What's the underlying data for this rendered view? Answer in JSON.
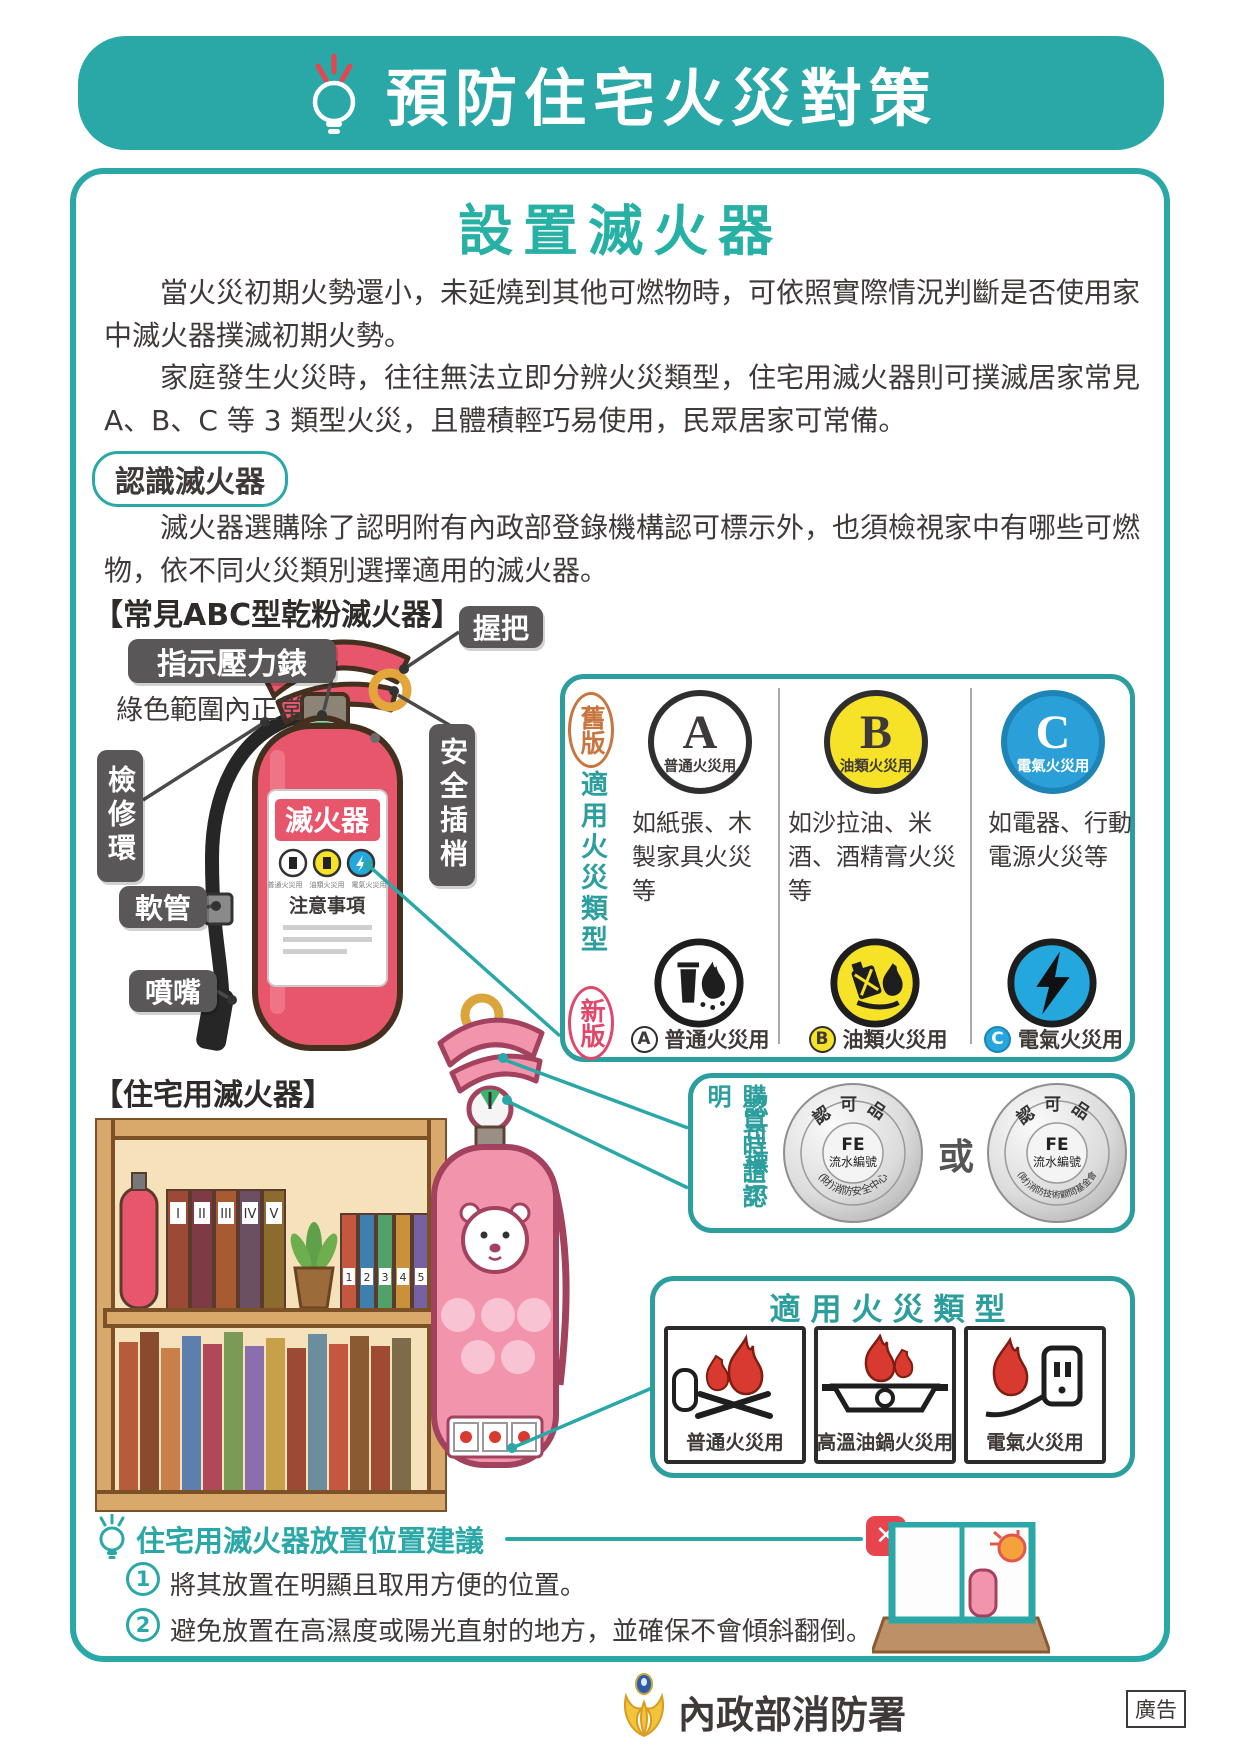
{
  "banner": {
    "title": "預防住宅火災對策"
  },
  "intro": {
    "heading": "設置滅火器",
    "para1": "當火災初期火勢還小，未延燒到其他可燃物時，可依照實際情況判斷是否使用家中滅火器撲滅初期火勢。",
    "para2": "家庭發生火災時，往往無法立即分辨火災類型，住宅用滅火器則可撲滅居家常見 A、B、C 等 3 類型火災，且體積輕巧易使用，民眾居家可常備。",
    "badge": "認識滅火器",
    "para3": "滅火器選購除了認明附有內政部登錄機構認可標示外，也須檢視家中有哪些可燃物，依不同火災類別選擇適用的滅火器。"
  },
  "abc_diagram": {
    "title": "【常見ABC型乾粉滅火器】",
    "label_handle": "握把",
    "label_gauge": "指示壓力錶",
    "gauge_note": "綠色範圍內正常",
    "label_ring": "檢修環",
    "label_pin": "安全插梢",
    "label_hose": "軟管",
    "label_nozzle": "噴嘴",
    "body_label": "滅火器",
    "mini_caption": "普通火災用　油類火災用　電氣火災用",
    "body_note": "注意事項"
  },
  "type_table": {
    "old_stamp": "舊版",
    "side_label": "適用火災類型",
    "new_stamp": "新版",
    "columns": [
      {
        "letter": "A",
        "badge_label": "普通火災用",
        "desc": "如紙張、木製家具火災等",
        "caption": "普通火災用"
      },
      {
        "letter": "B",
        "badge_label": "油類火災用",
        "desc": "如沙拉油、米酒、酒精膏火災等",
        "caption": "油類火災用"
      },
      {
        "letter": "C",
        "badge_label": "電氣火災用",
        "desc": "如電器、行動電源火災等",
        "caption": "電氣火災用"
      }
    ]
  },
  "home": {
    "title": "【住宅用滅火器】",
    "book_labels_roman": [
      "I",
      "II",
      "III",
      "IV",
      "V"
    ],
    "book_labels_num": [
      "1",
      "2",
      "3",
      "4",
      "5"
    ]
  },
  "approval": {
    "side_label_1": "購買時請認明",
    "side_label_2": "認可標示",
    "seal_top": "認可品",
    "seal_code": "FE",
    "seal_code_label": "流水編號",
    "seal1_org": "(財)消防安全中心",
    "or_text": "或",
    "seal2_org": "(財)消防技術顧問基金會"
  },
  "applicable": {
    "title": "適用火災類型",
    "items": [
      {
        "label": "普通火災用"
      },
      {
        "label": "高溫油鍋火災用"
      },
      {
        "label": "電氣火災用"
      }
    ]
  },
  "placement": {
    "title": "住宅用滅火器放置位置建議",
    "items": [
      {
        "num": "1",
        "text": "將其放置在明顯且取用方便的位置。"
      },
      {
        "num": "2",
        "text": "避免放置在高濕度或陽光直射的地方，並確保不會傾斜翻倒。"
      }
    ]
  },
  "footer": {
    "agency": "內政部消防署",
    "ad_label": "廣告"
  }
}
